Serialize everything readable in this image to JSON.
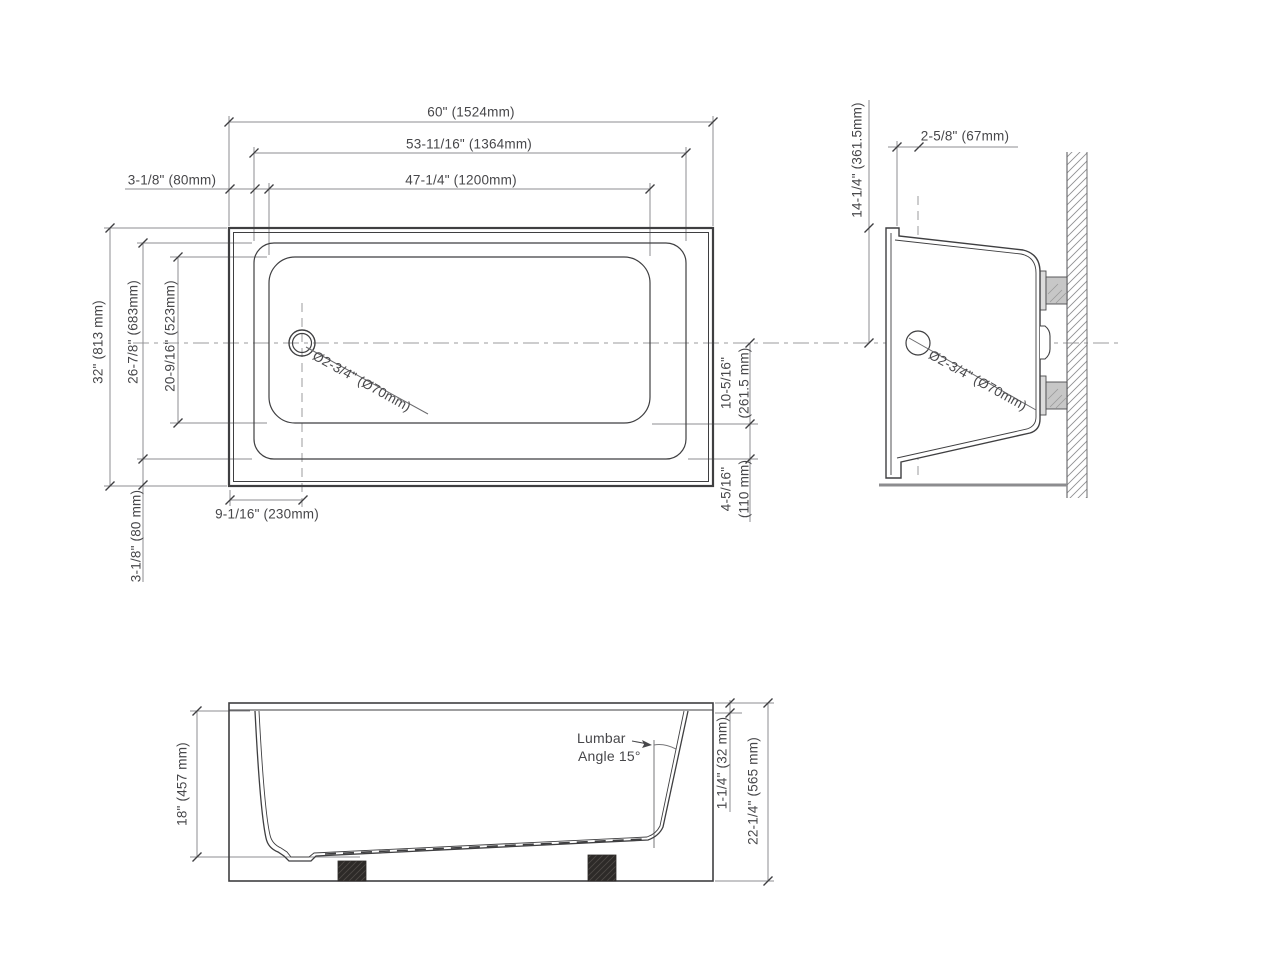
{
  "page": {
    "background": "#ffffff",
    "line_color": "#3f3f41",
    "dim_color": "#8e8e91",
    "text_color": "#47474a"
  },
  "plan_view": {
    "name": "top-view",
    "dims": {
      "overall_width": "60\" (1524mm)",
      "deck_width": "53-11/16\" (1364mm)",
      "basin_width": "47-1/4\" (1200mm)",
      "deck_offset_left": "3-1/8\" (80mm)",
      "overall_depth": "32\" (813 mm)",
      "deck_depth": "26-7/8\" (683mm)",
      "basin_depth": "20-9/16\" (523mm)",
      "deck_offset_bottom": "3-1/8\" (80 mm)",
      "drain_center_from_left": "9-1/16\" (230mm)",
      "center_to_basin_edge_in": "10-5/16\"",
      "center_to_basin_edge_mm": "(261.5 mm)",
      "basin_to_deck_edge_in": "4-5/16\"",
      "basin_to_deck_edge_mm": "(110 mm)",
      "drain_diameter": "Ø2-3/4\" (Ø70mm)"
    }
  },
  "end_view": {
    "name": "side-section-view",
    "dims": {
      "rim_to_drain_center": "14-1/4\" (361.5mm)",
      "drain_center_offset": "2-5/8\" (67mm)",
      "drain_diameter": "Ø2-3/4\" (Ø70mm)"
    }
  },
  "front_view": {
    "name": "front-elevation-view",
    "dims": {
      "basin_depth": "18\" (457 mm)",
      "rim_thickness": "1-1/4\" (32 mm)",
      "overall_height": "22-1/4\" (565 mm)",
      "lumbar_label_line1": "Lumbar",
      "lumbar_label_line2": "Angle 15°"
    }
  }
}
